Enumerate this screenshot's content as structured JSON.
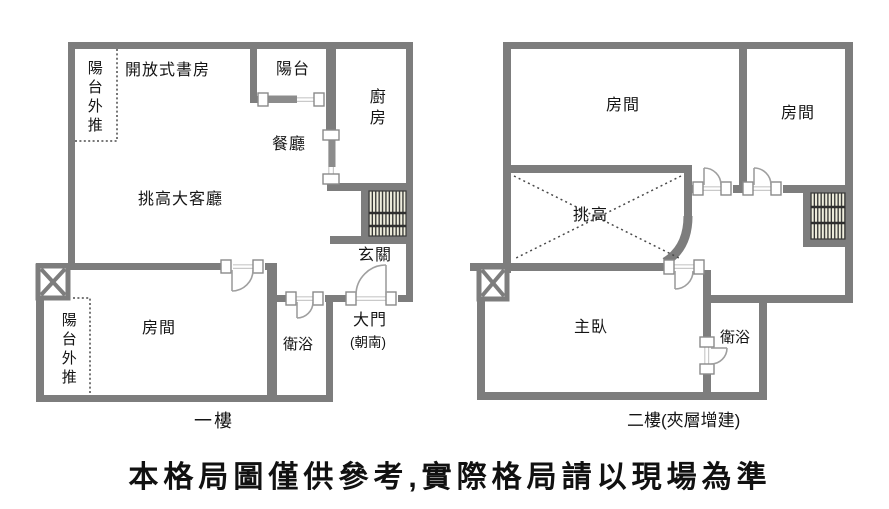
{
  "disclaimer": "本格局圖僅供參考,實際格局請以現場為準",
  "floor1": {
    "caption": "一樓",
    "labels": {
      "balcony_out_top": "陽台外推",
      "study": "開放式書房",
      "balcony": "陽台",
      "kitchen": "廚房",
      "dining": "餐廳",
      "living": "挑高大客廳",
      "entry": "玄關",
      "room": "房間",
      "bath": "衛浴",
      "main_door": "大門",
      "main_door_facing": "(朝南)",
      "balcony_out_bottom": "陽台外推"
    }
  },
  "floor2": {
    "caption": "二樓(夾層增建)",
    "labels": {
      "room_left": "房間",
      "room_right": "房間",
      "void": "挑高",
      "master": "主臥",
      "bath": "衛浴"
    }
  },
  "colors": {
    "wall": "#7d7d7d",
    "door_arc": "#9f9f9f",
    "stair_bg": "#efeedd",
    "stair_line": "#2e2e2e",
    "text": "#141414"
  }
}
